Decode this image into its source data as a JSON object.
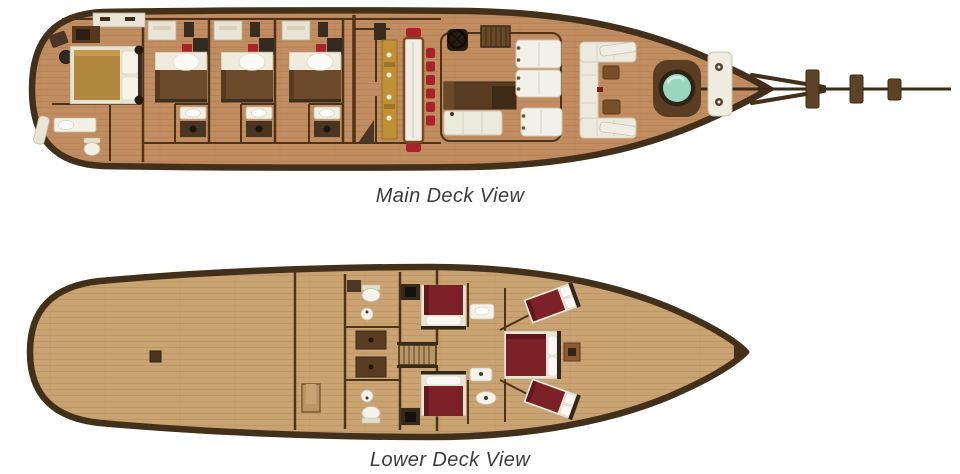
{
  "page": {
    "type": "yacht-deck-plan",
    "background_color": "#ffffff"
  },
  "decks": [
    {
      "id": "main-deck",
      "caption": "Main Deck View",
      "elements": [
        "aft-master-cabin",
        "master-bed",
        "master-bathroom",
        "wardrobe",
        "wall-shelf",
        "stool",
        "guest-cabin-1",
        "guest-cabin-2",
        "guest-cabin-3",
        "guest-bed",
        "guest-bathroom",
        "desk",
        "galley-counter",
        "dining-table",
        "dining-chairs",
        "companionway-stairs",
        "helm-wheel",
        "saloon-sofa",
        "bench-seat",
        "sun-pads",
        "bow-lounge-seating",
        "cocktail-tables",
        "skylight-porthole",
        "windlass",
        "deck-boxes",
        "bowsprit"
      ]
    },
    {
      "id": "lower-deck",
      "caption": "Lower Deck View",
      "elements": [
        "open-stern-area",
        "floor-hatch",
        "storage-bracket",
        "port-bathroom",
        "starboard-bathroom",
        "storage-cabinets",
        "staircase",
        "port-cabin-bed",
        "starboard-cabin-bed",
        "cabin-tv",
        "washbasin",
        "toilet",
        "vip-cabin-bed",
        "nightstand",
        "bow-port-bed",
        "bow-starboard-bed"
      ]
    }
  ],
  "colors": {
    "background": "#ffffff",
    "hull_outline": "#43301b",
    "wall": "#4d3419",
    "main_deck_floor": "#c08c60",
    "lower_deck_floor": "#c9a372",
    "cream_fixture": "#e9e5d6",
    "white_upholstery": "#f2f0e8",
    "guest_bed_blanket": "#6d4a2c",
    "master_bed_blanket": "#b2873e",
    "lower_bed_maroon": "#7c2128",
    "dining_chair_red": "#a8232a",
    "galley_counter": "#c09035",
    "skylight_teal": "#9ad6bf",
    "caption_text": "#3c3c3c"
  }
}
